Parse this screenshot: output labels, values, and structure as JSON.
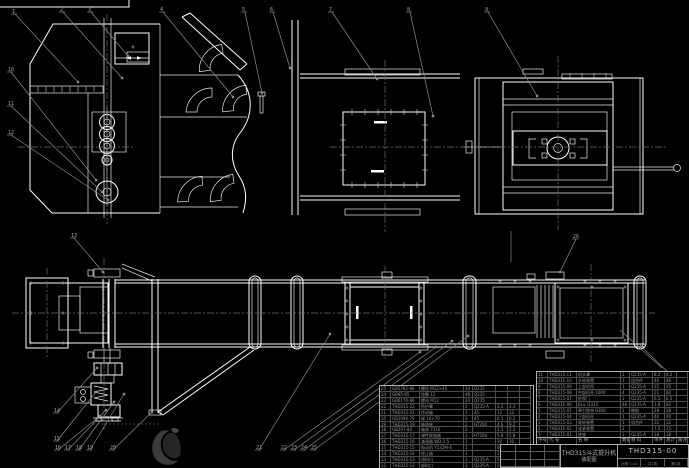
{
  "drawing": {
    "product": "THD315斗式提升机",
    "doc_type": "装配图",
    "drawing_no": "THD315-00",
    "meta_scale": "比例 1:10",
    "meta_sheets": "共1张",
    "meta_sheet_no": "第1张"
  },
  "bom_header": [
    "序号",
    "代  号",
    "名  称",
    "数量",
    "材  料",
    "单件",
    "总计",
    "备注"
  ],
  "bom_right": {
    "rows": [
      [
        "11",
        "THD315-11",
        "机头罩",
        "1",
        "Q235-A",
        "8.2",
        "8.2",
        ""
      ],
      [
        "10",
        "THD315-10",
        "头轮装置",
        "1",
        "组合件",
        "46",
        "46",
        ""
      ],
      [
        "9",
        "THD315-09",
        "上部机壳",
        "1",
        "Q235-A",
        "35",
        "35",
        ""
      ],
      [
        "8",
        "THD315-08",
        "中部机壳 1000",
        "4",
        "Q235-A",
        "21",
        "84",
        ""
      ],
      [
        "7",
        "THD315-07",
        "检视门",
        "1",
        "Q235-A",
        "6.5",
        "6.5",
        ""
      ],
      [
        "6",
        "THD315-06",
        "料斗 D315",
        "46",
        "Q235-A",
        "1.8",
        "83",
        ""
      ],
      [
        "5",
        "THD315-05",
        "牵引胶带 B300",
        "1",
        "橡胶",
        "28",
        "28",
        ""
      ],
      [
        "4",
        "THD315-04",
        "下部机壳",
        "1",
        "Q235-A",
        "40",
        "40",
        ""
      ],
      [
        "3",
        "THD315-03",
        "尾轮装置",
        "1",
        "组合件",
        "32",
        "32",
        ""
      ],
      [
        "2",
        "THD315-02",
        "张紧装置",
        "2",
        "",
        "7.5",
        "15",
        ""
      ],
      [
        "1",
        "THD315-01",
        "底座",
        "1",
        "Q235-A",
        "18",
        "18",
        ""
      ]
    ]
  },
  "bom_left": {
    "rows": [
      [
        "25",
        "GB5782-86",
        "螺栓 M12×45",
        "24",
        "Q235",
        "",
        ""
      ],
      [
        "24",
        "GB95-85",
        "垫圈 12",
        "48",
        "Q235",
        "",
        ""
      ],
      [
        "23",
        "GB6170-86",
        "螺母 M12",
        "24",
        "Q235",
        "",
        ""
      ],
      [
        "22",
        "THD315-22",
        "防护罩",
        "1",
        "Q235-A",
        "3.2",
        "3.2"
      ],
      [
        "21",
        "THD315-21",
        "传动轴",
        "1",
        "45",
        "12",
        "12"
      ],
      [
        "20",
        "GB1096-79",
        "键 16×70",
        "2",
        "45",
        "0.1",
        "0.2"
      ],
      [
        "19",
        "THD315-19",
        "轴承座",
        "2",
        "HT200",
        "4.6",
        "9.2"
      ],
      [
        "18",
        "GB297-84",
        "轴承 7310",
        "2",
        "",
        "1.1",
        "2.2"
      ],
      [
        "17",
        "THD315-17",
        "弹性联轴器",
        "1",
        "HT200",
        "5.8",
        "5.8"
      ],
      [
        "16",
        "THD315-16",
        "减速器 WD-1.5",
        "1",
        "",
        "30",
        "30"
      ],
      [
        "15",
        "THD315-15",
        "电动机 Y132M-4",
        "1",
        "",
        "68",
        "68"
      ],
      [
        "14",
        "THD315-14",
        "逆止器",
        "1",
        "",
        "2.4",
        "2.4"
      ],
      [
        "13",
        "THD315-13",
        "进料口",
        "1",
        "Q235-A",
        "5.5",
        "5.5"
      ],
      [
        "12",
        "THD315-12",
        "卸料口",
        "1",
        "Q235-A",
        "5.0",
        "5.0"
      ]
    ]
  },
  "callouts": [
    {
      "n": "1",
      "x": 12,
      "y": 12,
      "tx": 78,
      "ty": 82
    },
    {
      "n": "2",
      "x": 60,
      "y": 10,
      "tx": 122,
      "ty": 78
    },
    {
      "n": "3",
      "x": 88,
      "y": 10,
      "tx": 128,
      "ty": 56
    },
    {
      "n": "4",
      "x": 160,
      "y": 10,
      "tx": 233,
      "ty": 97
    },
    {
      "n": "5",
      "x": 242,
      "y": 10,
      "tx": 262,
      "ty": 93
    },
    {
      "n": "6",
      "x": 270,
      "y": 10,
      "tx": 290,
      "ty": 68
    },
    {
      "n": "7",
      "x": 329,
      "y": 10,
      "tx": 377,
      "ty": 79
    },
    {
      "n": "8",
      "x": 407,
      "y": 10,
      "tx": 433,
      "ty": 116
    },
    {
      "n": "9",
      "x": 485,
      "y": 10,
      "tx": 537,
      "ty": 96
    },
    {
      "n": "10",
      "x": 8,
      "y": 70,
      "tx": 96,
      "ty": 180
    },
    {
      "n": "11",
      "x": 8,
      "y": 104,
      "tx": 102,
      "ty": 192
    },
    {
      "n": "12",
      "x": 8,
      "y": 133,
      "tx": 108,
      "ty": 200
    },
    {
      "n": "13",
      "x": 71,
      "y": 236,
      "tx": 103,
      "ty": 272
    },
    {
      "n": "14",
      "x": 54,
      "y": 411,
      "tx": 97,
      "ty": 368
    },
    {
      "n": "15",
      "x": 54,
      "y": 439,
      "tx": 96,
      "ty": 392
    },
    {
      "n": "16",
      "x": 55,
      "y": 448,
      "tx": 100,
      "ty": 416
    },
    {
      "n": "17",
      "x": 65,
      "y": 448,
      "tx": 106,
      "ty": 410
    },
    {
      "n": "18",
      "x": 76,
      "y": 448,
      "tx": 114,
      "ty": 402
    },
    {
      "n": "19",
      "x": 87,
      "y": 448,
      "tx": 124,
      "ty": 394
    },
    {
      "n": "20",
      "x": 110,
      "y": 448,
      "tx": 152,
      "ty": 412
    },
    {
      "n": "21",
      "x": 256,
      "y": 448,
      "tx": 330,
      "ty": 334
    },
    {
      "n": "22",
      "x": 281,
      "y": 448,
      "tx": 420,
      "ty": 352
    },
    {
      "n": "23",
      "x": 291,
      "y": 448,
      "tx": 436,
      "ty": 347
    },
    {
      "n": "24",
      "x": 301,
      "y": 448,
      "tx": 452,
      "ty": 341
    },
    {
      "n": "25",
      "x": 311,
      "y": 448,
      "tx": 468,
      "ty": 336
    },
    {
      "n": "26",
      "x": 573,
      "y": 237,
      "tx": 560,
      "ty": 272
    }
  ],
  "extra_leaders": [
    [
      640,
      345,
      688,
      392
    ],
    [
      620,
      330,
      662,
      368
    ],
    [
      511,
      231,
      511,
      262
    ]
  ],
  "colors": {
    "background": "#000000",
    "line": "#ffffff",
    "leader": "#8c8c8c",
    "centerline": "#6e6e6e",
    "text": "#9a9a9a",
    "watermark": "#3c3c3c"
  }
}
